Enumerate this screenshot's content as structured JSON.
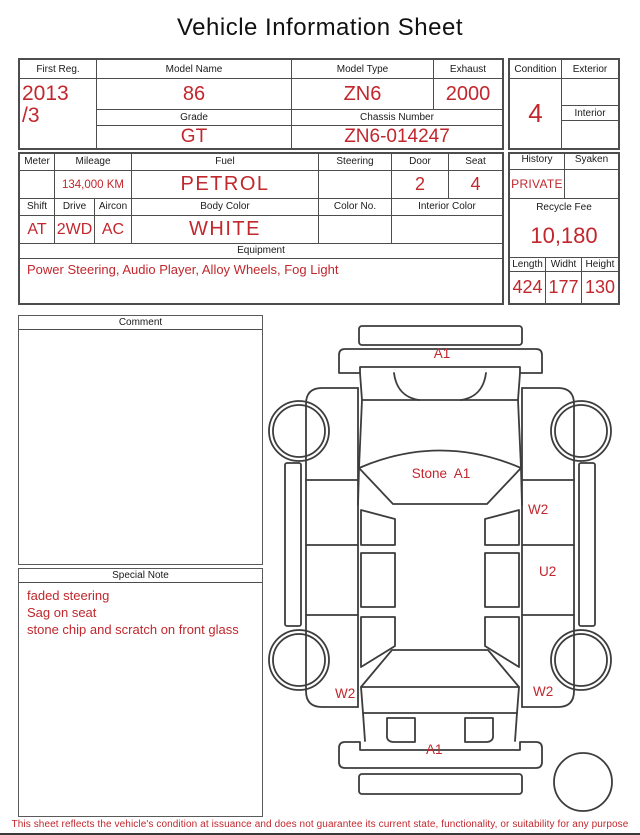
{
  "title": "Vehicle Information Sheet",
  "accent_color": "#c1272d",
  "line_color": "#4d4d4d",
  "section1": {
    "first_reg": {
      "label": "First Reg.",
      "value_line1": "2013",
      "value_line2": "/3"
    },
    "model_name": {
      "label": "Model Name",
      "value": "86"
    },
    "model_type": {
      "label": "Model Type",
      "value": "ZN6"
    },
    "exhaust": {
      "label": "Exhaust",
      "value": "2000"
    },
    "grade": {
      "label": "Grade",
      "value": "GT"
    },
    "chassis_number": {
      "label": "Chassis Number",
      "value": "ZN6-014247"
    },
    "condition": {
      "label": "Condition",
      "value": "4"
    },
    "exterior": {
      "label": "Exterior",
      "value": ""
    },
    "interior": {
      "label": "Interior",
      "value": ""
    }
  },
  "section2": {
    "meter": {
      "label": "Meter",
      "value": ""
    },
    "mileage": {
      "label": "Mileage",
      "value": "134,000 KM"
    },
    "fuel": {
      "label": "Fuel",
      "value": "PETROL"
    },
    "steering": {
      "label": "Steering",
      "value": ""
    },
    "door": {
      "label": "Door",
      "value": "2"
    },
    "seat": {
      "label": "Seat",
      "value": "4"
    },
    "shift": {
      "label": "Shift",
      "value": "AT"
    },
    "drive": {
      "label": "Drive",
      "value": "2WD"
    },
    "aircon": {
      "label": "Aircon",
      "value": "AC"
    },
    "body_color": {
      "label": "Body Color",
      "value": "WHITE"
    },
    "color_no": {
      "label": "Color No.",
      "value": ""
    },
    "interior_color": {
      "label": "Interior Color",
      "value": ""
    },
    "equipment": {
      "label": "Equipment",
      "value": "Power Steering, Audio Player, Alloy Wheels, Fog Light"
    }
  },
  "right_panel": {
    "history": {
      "label": "History",
      "value": "PRIVATE"
    },
    "syaken": {
      "label": "Syaken",
      "value": ""
    },
    "recycle_fee": {
      "label": "Recycle Fee",
      "value": "10,180"
    },
    "length": {
      "label": "Length",
      "value": "424"
    },
    "width": {
      "label": "Widht",
      "value": "177"
    },
    "height": {
      "label": "Height",
      "value": "130"
    }
  },
  "comment": {
    "label": "Comment",
    "value": ""
  },
  "special_note": {
    "label": "Special Note",
    "lines": [
      "faded steering",
      "Sag on seat",
      "stone chip and scratch on front glass"
    ]
  },
  "diagram": {
    "labels": {
      "front_bumper": "A1",
      "windshield": "Stone  A1",
      "right_front_door": "W2",
      "right_rear_door": "U2",
      "left_rear_fender": "W2",
      "right_rear_fender": "W2",
      "rear_bumper": "A1"
    }
  },
  "footer": "This sheet reflects the vehicle's condition at issuance and does not guarantee its current state, functionality, or suitability for any purpose"
}
